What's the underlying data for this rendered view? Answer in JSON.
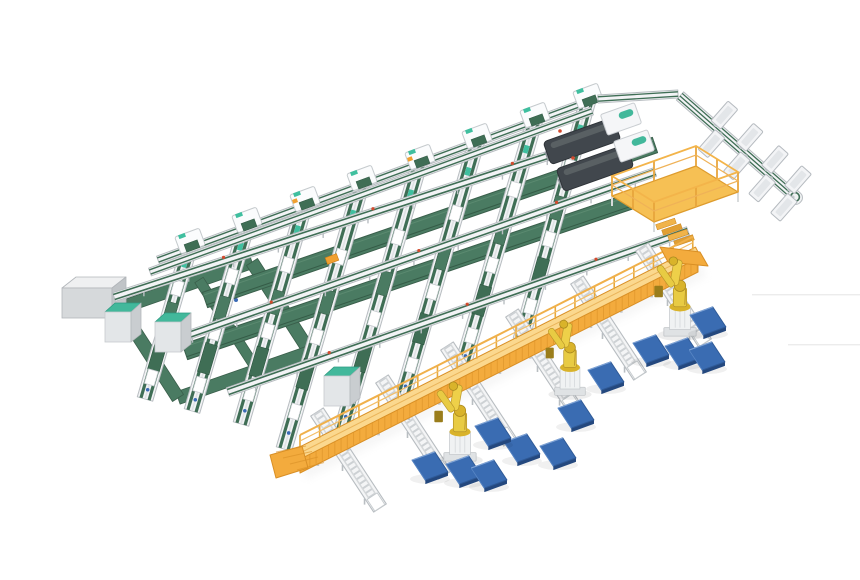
{
  "scene": {
    "kind": "isometric-3d-render",
    "subject": "automated-conveyor-sorting-and-palletizing-line",
    "canvas": {
      "width": 860,
      "height": 580
    },
    "colors": {
      "background": "#ffffff",
      "belt_green": "#3f6e55",
      "belt_green_dark": "#2f5742",
      "band_green": "#4a7b62",
      "band_edge": "#3a5f4b",
      "teal_accent": "#3fbf9f",
      "teal_top": "#42b89b",
      "frame_white": "#f2f3f5",
      "frame_gray": "#b8bdc1",
      "frame_mid": "#d6d9db",
      "gantry_yellow": "#f3ab3d",
      "gantry_light": "#fbd88e",
      "gantry_dark": "#d98f25",
      "robot_yellow": "#e8cb43",
      "robot_mid": "#d9b32a",
      "robot_dark": "#b8952a",
      "robot_grip": "#9a7d1b",
      "pallet_blue": "#3a6cb2",
      "pallet_dark": "#24487e",
      "pallet_light": "#7ea3d6",
      "machine_dark": "#41474d",
      "machine_ridge": "#2e3338",
      "machine_top": "#596063",
      "platform_yellow": "#f6c054",
      "platform_edge": "#de9c2e",
      "cabinet_front": "#d6d9db",
      "cabinet_top": "#eff0f1",
      "cabinet_side": "#c0c4c7",
      "dot_red": "#d34a2e",
      "dot_blue": "#3a6ab5",
      "accent_orange": "#f0a030",
      "shadow": "#dddddd"
    },
    "grid": {
      "boundary": [
        158,
        260,
        600,
        97
      ],
      "boundary2": [
        150,
        272,
        592,
        111
      ],
      "corner_strip": [
        598,
        99,
        678,
        94
      ],
      "stations": [
        [
          190,
          245
        ],
        [
          247,
          224
        ],
        [
          305,
          203
        ],
        [
          362,
          182
        ],
        [
          420,
          161
        ],
        [
          477,
          140
        ],
        [
          535,
          119
        ],
        [
          588,
          100
        ]
      ],
      "lanes": [
        [
          190,
          245,
          145,
          399
        ],
        [
          247,
          224,
          192,
          411
        ],
        [
          305,
          203,
          241,
          424
        ],
        [
          362,
          182,
          284,
          449
        ],
        [
          420,
          161,
          341,
          433
        ],
        [
          477,
          140,
          401,
          402
        ],
        [
          535,
          119,
          461,
          371
        ],
        [
          588,
          100,
          521,
          340
        ]
      ],
      "wide_bands": [
        [
          205,
          300,
          655,
          145
        ],
        [
          185,
          352,
          640,
          198
        ]
      ],
      "cross_lines": [
        [
          114,
          297,
          612,
          135
        ],
        [
          163,
          344,
          655,
          172
        ],
        [
          228,
          392,
          688,
          231
        ]
      ],
      "yellow_marker": [
        332,
        259
      ]
    },
    "gantry": {
      "line": [
        300,
        453,
        698,
        252
      ],
      "ramp_sw": true,
      "ramp_ne": true
    },
    "roller_spurs": {
      "anchors": [
        [
          333,
          437
        ],
        [
          398,
          404
        ],
        [
          463,
          371
        ],
        [
          528,
          338
        ],
        [
          593,
          305
        ],
        [
          658,
          272
        ]
      ]
    },
    "robots": [
      {
        "x": 460,
        "y": 445,
        "scale": 0.95
      },
      {
        "x": 570,
        "y": 380,
        "scale": 0.9
      },
      {
        "x": 680,
        "y": 320,
        "scale": 0.95
      }
    ],
    "pallets": [
      [
        708,
        321
      ],
      [
        651,
        349
      ],
      [
        683,
        352
      ],
      [
        707,
        356
      ],
      [
        606,
        376
      ],
      [
        576,
        414
      ],
      [
        522,
        448
      ],
      [
        558,
        452
      ],
      [
        493,
        432
      ],
      [
        430,
        466
      ],
      [
        464,
        470
      ],
      [
        489,
        474
      ]
    ],
    "tote_spur": {
      "line": [
        680,
        96,
        795,
        197
      ],
      "upper_t": [
        0.3,
        0.52,
        0.74,
        0.94
      ],
      "lower_t": [
        0.36,
        0.58,
        0.8,
        0.99
      ],
      "offset": 15
    },
    "machines": [
      {
        "body": [
          582,
          141
        ],
        "head": [
          621,
          119
        ],
        "pill": [
          626,
          114
        ],
        "dot": [
          560,
          131
        ]
      },
      {
        "body": [
          595,
          168
        ],
        "head": [
          634,
          146
        ],
        "pill": [
          639,
          141
        ],
        "dot": [
          573,
          158
        ]
      }
    ],
    "platform": {
      "floor": [
        [
          612,
          196
        ],
        [
          696,
          166
        ],
        [
          738,
          192
        ],
        [
          654,
          222
        ]
      ],
      "posts": [
        [
          612,
          196
        ],
        [
          654,
          181
        ],
        [
          696,
          166
        ],
        [
          717,
          179
        ],
        [
          738,
          192
        ],
        [
          696,
          207
        ],
        [
          654,
          222
        ],
        [
          633,
          209
        ]
      ],
      "stairs_origin": [
        666,
        224
      ]
    },
    "cabinet": {
      "x": 62,
      "y": 288,
      "w": 50,
      "h": 30,
      "dx": 14,
      "dy": 11
    },
    "loop": {
      "corners": [
        [
          120,
          308
        ],
        [
          252,
          262
        ],
        [
          310,
          352
        ],
        [
          178,
          398
        ]
      ],
      "divider": [
        [
          199,
          280
        ],
        [
          257,
          370
        ]
      ]
    },
    "teal_cabinets": [
      [
        118,
        312
      ],
      [
        168,
        322
      ],
      [
        337,
        376
      ]
    ],
    "shadow_lines": [
      [
        752,
        294,
        860
      ],
      [
        788,
        344,
        860
      ]
    ],
    "counts": {
      "lanes": 8,
      "robots": 3,
      "pallets": 12,
      "totes": 8,
      "machines": 2,
      "roller_spurs": 6,
      "induct_stations": 8
    }
  }
}
